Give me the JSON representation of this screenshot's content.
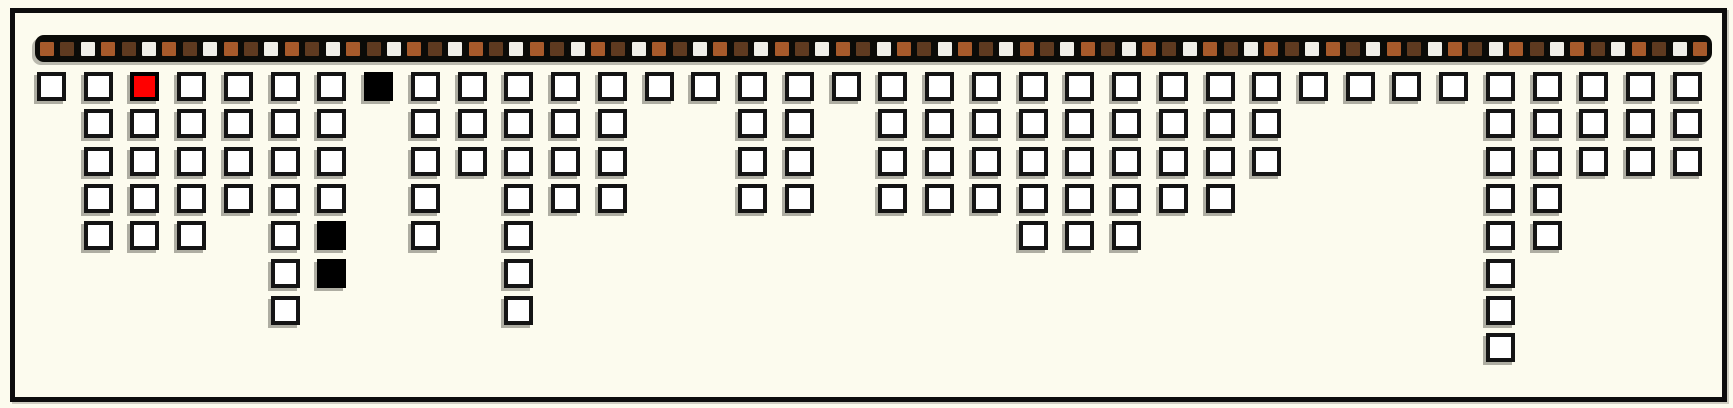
{
  "palette": {
    "background": "#FCFBEE",
    "frame_border": "#0D0D0D",
    "bar_background": "#0B0B08",
    "strip_colors": {
      "sienna": "#A75A2B",
      "dark_brown": "#5E3A20",
      "off_white": "#F0EFE8"
    },
    "cell_fill": "#FFFFFF",
    "cell_border": "#141414",
    "cell_shadow_gray": "#8E8E86",
    "highlight_red": "#FF0000",
    "filled_black": "#000000"
  },
  "strip": {
    "square_count": 82,
    "pattern": [
      "sienna",
      "dark_brown",
      "off_white"
    ]
  },
  "chart_data": {
    "type": "bar",
    "title": "",
    "xlabel": "",
    "ylabel": "",
    "orientation": "columns of outlined squares hanging downward from the top strip",
    "categories": [
      1,
      2,
      3,
      4,
      5,
      6,
      7,
      8,
      9,
      10,
      11,
      12,
      13,
      14,
      15,
      16,
      17,
      18,
      19,
      20,
      21,
      22,
      23,
      24,
      25,
      26,
      27,
      28,
      29,
      30,
      31,
      32,
      33,
      34,
      35,
      36
    ],
    "values": [
      1,
      5,
      5,
      5,
      4,
      7,
      6,
      1,
      5,
      3,
      7,
      4,
      4,
      1,
      1,
      4,
      4,
      1,
      4,
      4,
      4,
      5,
      5,
      5,
      4,
      4,
      3,
      1,
      1,
      1,
      1,
      8,
      5,
      3,
      3,
      3
    ],
    "ylim": [
      0,
      8
    ],
    "grid": false,
    "legend": "none",
    "special_cells": [
      {
        "column": 3,
        "row": 1,
        "color": "red"
      },
      {
        "column": 7,
        "row": 5,
        "color": "black"
      },
      {
        "column": 7,
        "row": 6,
        "color": "black"
      },
      {
        "column": 8,
        "row": 1,
        "color": "black"
      }
    ],
    "top_strip_sequence_note": "82 small squares repeating sienna, dark_brown, off_white on a black rounded bar"
  }
}
